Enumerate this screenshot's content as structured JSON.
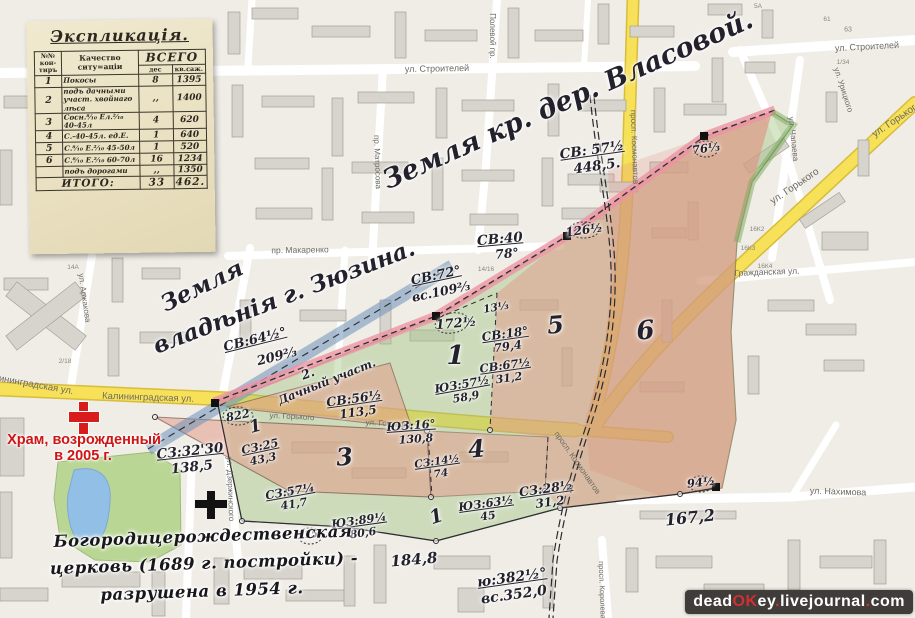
{
  "watermark": {
    "p1": "dead",
    "p2": "OK",
    "p3": "ey",
    "p4": ".",
    "p5": "livejournal",
    "p6": ".",
    "p7": "com"
  },
  "colors": {
    "overlay_green": "#9ec47e",
    "overlay_pink": "#e89a8a",
    "road_yellow": "#f7e159",
    "ink": "#23222c",
    "red_marker": "#d81c1c"
  },
  "explication_table": {
    "title": "Экспликація.",
    "col_contour": "№№ кон-тиръ",
    "col_quality": "Качество ситу=аціи",
    "col_total": "ВСЕГО",
    "col_des": "дес",
    "col_sazh": "кв.саж.",
    "rows": [
      {
        "n": "1",
        "quality": "Покосы",
        "des": "8",
        "sazh": "1395"
      },
      {
        "n": "2",
        "quality": "подъ дачными участ. хвойнаго лѣса",
        "des": ",,",
        "sazh": "1400"
      },
      {
        "n": "3",
        "quality": "Сосн.⁸⁄₁₀ Ел.²⁄₁₀ 40-45л",
        "des": "4",
        "sazh": "620"
      },
      {
        "n": "4",
        "quality": "С.-40-45л. ед.Е.",
        "des": "1",
        "sazh": "640"
      },
      {
        "n": "5",
        "quality": "С.⁸⁄₁₀ Е.²⁄₁₀ 45-50л",
        "des": "1",
        "sazh": "520"
      },
      {
        "n": "6",
        "quality": "С.⁸⁄₁₀ Е.²⁄₁₀ 60-70л",
        "des": "16",
        "sazh": "1234"
      },
      {
        "n": "",
        "quality": "подъ дорогами",
        "des": ",,",
        "sazh": "1350"
      }
    ],
    "total_label": "ИТОГО:",
    "total_des": "33",
    "total_sazh": "462."
  },
  "map": {
    "street_labels": [
      {
        "t": "ул. Строителей",
        "x": 437,
        "y": 69,
        "r": -1,
        "s": 9
      },
      {
        "t": "ул. Строителей",
        "x": 867,
        "y": 47,
        "r": -3,
        "s": 9
      },
      {
        "t": "Полевой пр.",
        "x": 492,
        "y": 36,
        "r": 90,
        "s": 8
      },
      {
        "t": "пр. Матросова",
        "x": 377,
        "y": 162,
        "r": 88,
        "s": 8
      },
      {
        "t": "пр. Макаренко",
        "x": 300,
        "y": 250,
        "r": -1,
        "s": 8.5
      },
      {
        "t": "ул. Аржакова",
        "x": 84,
        "y": 298,
        "r": 82,
        "s": 8
      },
      {
        "t": "ул. Дзержинского",
        "x": 230,
        "y": 489,
        "r": 88,
        "s": 8
      },
      {
        "t": "Калининградская ул.",
        "x": 148,
        "y": 398,
        "r": 2,
        "s": 9.5
      },
      {
        "t": "Калининградская ул.",
        "x": 28,
        "y": 384,
        "r": 10,
        "s": 9.5
      },
      {
        "t": "ул. Горького",
        "x": 292,
        "y": 417,
        "r": 3,
        "s": 8
      },
      {
        "t": "ул. Горького",
        "x": 388,
        "y": 424,
        "r": 3,
        "s": 8
      },
      {
        "t": "ул. Горького",
        "x": 795,
        "y": 187,
        "r": -34,
        "s": 10
      },
      {
        "t": "ул. Горького",
        "x": 897,
        "y": 120,
        "r": -34,
        "s": 10
      },
      {
        "t": "просп. Космонавтов",
        "x": 634,
        "y": 147,
        "r": 88,
        "s": 8
      },
      {
        "t": "просп. Космонавтов",
        "x": 577,
        "y": 463,
        "r": 55,
        "s": 8
      },
      {
        "t": "просп. Королева",
        "x": 602,
        "y": 590,
        "r": 88,
        "s": 7.5
      },
      {
        "t": "ул. Чапаева",
        "x": 793,
        "y": 139,
        "r": 84,
        "s": 8
      },
      {
        "t": "ул. Урицкого",
        "x": 843,
        "y": 90,
        "r": 72,
        "s": 8
      },
      {
        "t": "Гражданская ул.",
        "x": 767,
        "y": 272,
        "r": -2,
        "s": 8.5
      },
      {
        "t": "ул. Нахимова",
        "x": 838,
        "y": 492,
        "r": 2,
        "s": 9
      }
    ],
    "building_labels": [
      {
        "t": "5А",
        "x": 758,
        "y": 7,
        "s": 6.5
      },
      {
        "t": "61",
        "x": 827,
        "y": 20,
        "s": 6.5
      },
      {
        "t": "63",
        "x": 848,
        "y": 30,
        "s": 7
      },
      {
        "t": "1/34",
        "x": 843,
        "y": 63,
        "s": 6.5
      },
      {
        "t": "14/16",
        "x": 486,
        "y": 270,
        "s": 6.5
      },
      {
        "t": "14А",
        "x": 73,
        "y": 268,
        "s": 6.5
      },
      {
        "t": "2/18",
        "x": 65,
        "y": 362,
        "s": 6.5
      },
      {
        "t": "16К2",
        "x": 757,
        "y": 230,
        "s": 6.5
      },
      {
        "t": "16К3",
        "x": 748,
        "y": 249,
        "s": 6.5
      },
      {
        "t": "16К4",
        "x": 765,
        "y": 267,
        "s": 6.5
      }
    ],
    "annotations": [
      {
        "t": "Земля кр. дер. Власовой.",
        "x": 568,
        "y": 100,
        "r": -24,
        "s": 27,
        "c": "i",
        "n": "land-owner-vlasova-label"
      },
      {
        "t": "Земля",
        "x": 202,
        "y": 286,
        "r": -26,
        "s": 23,
        "c": "i",
        "n": "land-owner-zyuzin-label"
      },
      {
        "t": "владѣнія г. Зюзина.",
        "x": 284,
        "y": 297,
        "r": -21,
        "s": 23,
        "c": "i",
        "n": "land-owner-zyuzin-label"
      },
      {
        "t": "СВ: 57½",
        "x": 592,
        "y": 151,
        "r": -8,
        "s": 13.5,
        "c": "u"
      },
      {
        "t": "448,5.",
        "x": 597,
        "y": 167,
        "r": -8,
        "s": 13.5,
        "c": "i"
      },
      {
        "t": "СВ:40",
        "x": 500,
        "y": 240,
        "r": -5,
        "s": 13.5,
        "c": "u"
      },
      {
        "t": "78°",
        "x": 507,
        "y": 254,
        "r": -5,
        "s": 12.5,
        "c": "i"
      },
      {
        "t": "СВ:72°",
        "x": 436,
        "y": 276,
        "r": -12,
        "s": 13,
        "c": "u"
      },
      {
        "t": "вс.109⅔",
        "x": 441,
        "y": 292,
        "r": -12,
        "s": 12.5,
        "c": "i"
      },
      {
        "t": "172½",
        "x": 456,
        "y": 324,
        "r": -5,
        "s": 13,
        "c": "i"
      },
      {
        "t": "126½",
        "x": 584,
        "y": 230,
        "r": -8,
        "s": 12,
        "c": "i"
      },
      {
        "t": "76⅓",
        "x": 706,
        "y": 149,
        "r": -8,
        "s": 11.5,
        "c": "i"
      },
      {
        "t": "СВ:64½°",
        "x": 255,
        "y": 340,
        "r": -14,
        "s": 13,
        "c": "u"
      },
      {
        "t": "209⅔",
        "x": 277,
        "y": 357,
        "r": -14,
        "s": 13,
        "c": "i"
      },
      {
        "t": "13⅓",
        "x": 496,
        "y": 308,
        "r": -10,
        "s": 10.5,
        "c": "i"
      },
      {
        "t": "СВ:18°",
        "x": 505,
        "y": 334,
        "r": -8,
        "s": 12,
        "c": "u"
      },
      {
        "t": "79,4",
        "x": 508,
        "y": 347,
        "r": -8,
        "s": 11.5,
        "c": "i"
      },
      {
        "t": "СВ:67½",
        "x": 505,
        "y": 366,
        "r": -8,
        "s": 11.5,
        "c": "u"
      },
      {
        "t": "31,2",
        "x": 509,
        "y": 378,
        "r": -8,
        "s": 11,
        "c": "i"
      },
      {
        "t": "ЮЗ:57½",
        "x": 462,
        "y": 385,
        "r": -10,
        "s": 11.5,
        "c": "u"
      },
      {
        "t": "58,9",
        "x": 466,
        "y": 397,
        "r": -10,
        "s": 11,
        "c": "i"
      },
      {
        "t": "СВ:56½",
        "x": 354,
        "y": 399,
        "r": -8,
        "s": 12.5,
        "c": "u"
      },
      {
        "t": "113,5",
        "x": 358,
        "y": 412,
        "r": -8,
        "s": 12,
        "c": "i"
      },
      {
        "t": "2.",
        "x": 308,
        "y": 374,
        "r": -20,
        "s": 12.5,
        "c": "i"
      },
      {
        "t": "Дачный участ.",
        "x": 327,
        "y": 382,
        "r": -22,
        "s": 11.5,
        "c": "i",
        "n": "dacha-plot-label"
      },
      {
        "t": "ЮЗ:16°",
        "x": 411,
        "y": 426,
        "r": -4,
        "s": 11.5,
        "c": "u"
      },
      {
        "t": "130,8",
        "x": 416,
        "y": 439,
        "r": -4,
        "s": 11,
        "c": "i"
      },
      {
        "t": "СЗ:25",
        "x": 260,
        "y": 447,
        "r": -12,
        "s": 11.5,
        "c": "u"
      },
      {
        "t": "43,3",
        "x": 263,
        "y": 459,
        "r": -12,
        "s": 11,
        "c": "i"
      },
      {
        "t": "СЗ:32'30",
        "x": 190,
        "y": 452,
        "r": -6,
        "s": 13.5,
        "c": "u"
      },
      {
        "t": "138,5",
        "x": 192,
        "y": 468,
        "r": -6,
        "s": 13.5,
        "c": "i"
      },
      {
        "t": "СЗ:57¼",
        "x": 290,
        "y": 492,
        "r": -10,
        "s": 11.5,
        "c": "u"
      },
      {
        "t": "41,7",
        "x": 294,
        "y": 504,
        "r": -10,
        "s": 11,
        "c": "i"
      },
      {
        "t": "ЮЗ:89¼",
        "x": 359,
        "y": 521,
        "r": -8,
        "s": 11.5,
        "c": "u"
      },
      {
        "t": "80,6",
        "x": 363,
        "y": 533,
        "r": -8,
        "s": 11,
        "c": "i"
      },
      {
        "t": "115°",
        "x": 310,
        "y": 535,
        "r": -6,
        "s": 10.5,
        "c": "i"
      },
      {
        "t": "СЗ:14½",
        "x": 437,
        "y": 462,
        "r": -8,
        "s": 10.5,
        "c": "u"
      },
      {
        "t": "74",
        "x": 441,
        "y": 474,
        "r": -8,
        "s": 10.5,
        "c": "i"
      },
      {
        "t": "ЮЗ:63½",
        "x": 486,
        "y": 504,
        "r": -8,
        "s": 11.5,
        "c": "u"
      },
      {
        "t": "45",
        "x": 488,
        "y": 516,
        "r": -8,
        "s": 11,
        "c": "i"
      },
      {
        "t": "СЗ:28½",
        "x": 546,
        "y": 489,
        "r": -8,
        "s": 12.5,
        "c": "u"
      },
      {
        "t": "31,2",
        "x": 550,
        "y": 502,
        "r": -8,
        "s": 12,
        "c": "i"
      },
      {
        "t": "94½",
        "x": 701,
        "y": 483,
        "r": -6,
        "s": 11.5,
        "c": "i"
      },
      {
        "t": "167,2",
        "x": 690,
        "y": 518,
        "r": -6,
        "s": 16,
        "c": "i"
      },
      {
        "t": "184,8",
        "x": 414,
        "y": 560,
        "r": -5,
        "s": 15,
        "c": "i"
      },
      {
        "t": "ю:382½°",
        "x": 512,
        "y": 578,
        "r": -8,
        "s": 14,
        "c": "u"
      },
      {
        "t": "вс.352,0",
        "x": 514,
        "y": 595,
        "r": -8,
        "s": 14,
        "c": "i"
      },
      {
        "t": "822",
        "x": 238,
        "y": 416,
        "r": -12,
        "s": 11.5,
        "c": "i"
      },
      {
        "t": "1",
        "x": 456,
        "y": 356,
        "r": 0,
        "s": 26,
        "c": "p"
      },
      {
        "t": "1",
        "x": 256,
        "y": 427,
        "r": -15,
        "s": 17,
        "c": "p"
      },
      {
        "t": "1",
        "x": 437,
        "y": 517,
        "r": -18,
        "s": 19,
        "c": "p"
      },
      {
        "t": "3",
        "x": 345,
        "y": 457,
        "r": -5,
        "s": 24,
        "c": "p"
      },
      {
        "t": "4",
        "x": 477,
        "y": 449,
        "r": -5,
        "s": 24,
        "c": "p"
      },
      {
        "t": "5",
        "x": 556,
        "y": 325,
        "r": -5,
        "s": 24,
        "c": "p"
      },
      {
        "t": "6",
        "x": 646,
        "y": 331,
        "r": -5,
        "s": 26,
        "c": "p"
      },
      {
        "t": "Храм, возрожденный",
        "x": 84,
        "y": 440,
        "r": 0,
        "s": 14.5,
        "c": "red"
      },
      {
        "t": "в 2005 г.",
        "x": 83,
        "y": 456,
        "r": 0,
        "s": 14.5,
        "c": "red"
      },
      {
        "t": "Богородицерождественская",
        "x": 203,
        "y": 537,
        "r": -2,
        "s": 16.5,
        "c": "scr"
      },
      {
        "t": "церковь (1689 г. постройки) -",
        "x": 204,
        "y": 564,
        "r": -2,
        "s": 16.5,
        "c": "scr"
      },
      {
        "t": "разрушена в 1954 г.",
        "x": 202,
        "y": 592,
        "r": -2,
        "s": 16.5,
        "c": "scr"
      }
    ]
  }
}
